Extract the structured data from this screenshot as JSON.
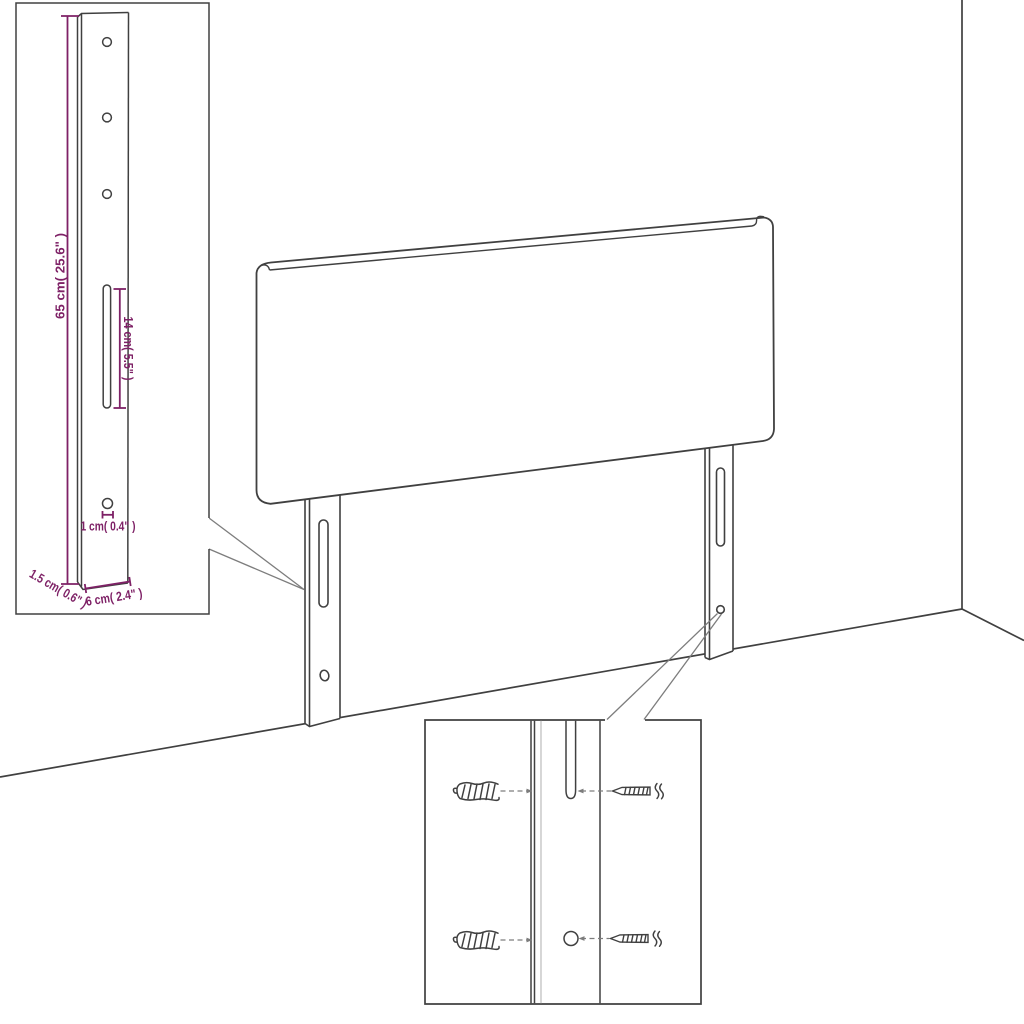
{
  "diagram": {
    "kind": "furniture-dimension-diagram",
    "subject": "upholstered headboard with two mounting legs, leg detail inset and screw hardware inset",
    "colors": {
      "outline": "#404040",
      "callout": "#7d7d7d",
      "dimension": "#7e2166",
      "background": "#ffffff",
      "shade": "#bcbcbc"
    },
    "annotations": {
      "leg_height": "65 cm( 25.6\" )",
      "slot_length": "14 cm( 5.5\" )",
      "hole_diameter": "1 cm( 0.4\" )",
      "leg_depth": "1.5 cm( 0.6\" )",
      "leg_width": "6 cm( 2.4\" )"
    }
  }
}
